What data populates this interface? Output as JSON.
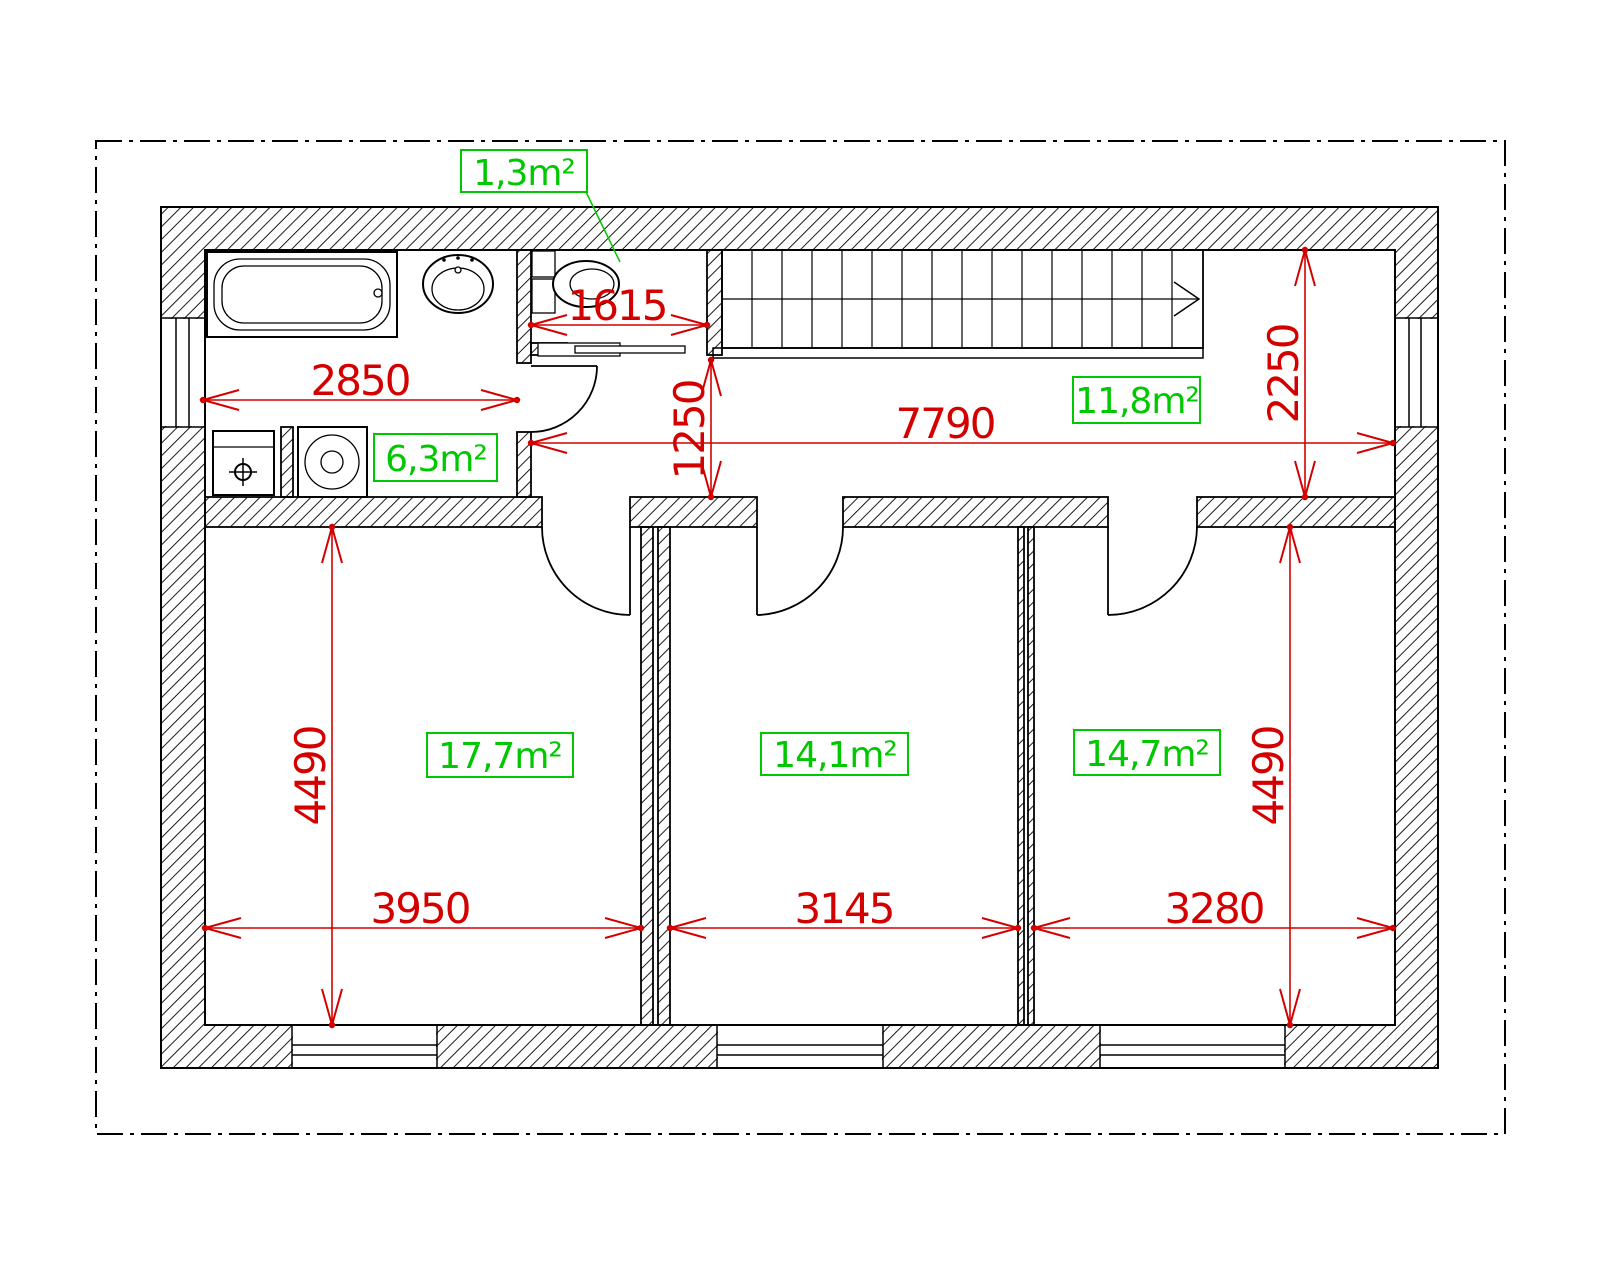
{
  "plan": {
    "labels": {
      "wc_area": "1,3m²",
      "bathroom_area": "6,3m²",
      "hall_area": "11,8m²",
      "bedroom_left_area": "17,7m²",
      "bedroom_middle_area": "14,1m²",
      "bedroom_right_area": "14,7m²"
    },
    "dimensions": {
      "bathroom_width": "2850",
      "wc_width": "1615",
      "hall_width": "7790",
      "hall_depth": "2250",
      "corridor_width": "1250",
      "bedroom_left_width": "3950",
      "bedroom_left_depth": "4490",
      "bedroom_middle_width": "3145",
      "bedroom_right_width": "3280",
      "bedroom_right_depth": "4490"
    },
    "colors": {
      "dimension_red": "#d40000",
      "area_green": "#00c800",
      "drawing_black": "#000000",
      "background": "#ffffff"
    }
  }
}
